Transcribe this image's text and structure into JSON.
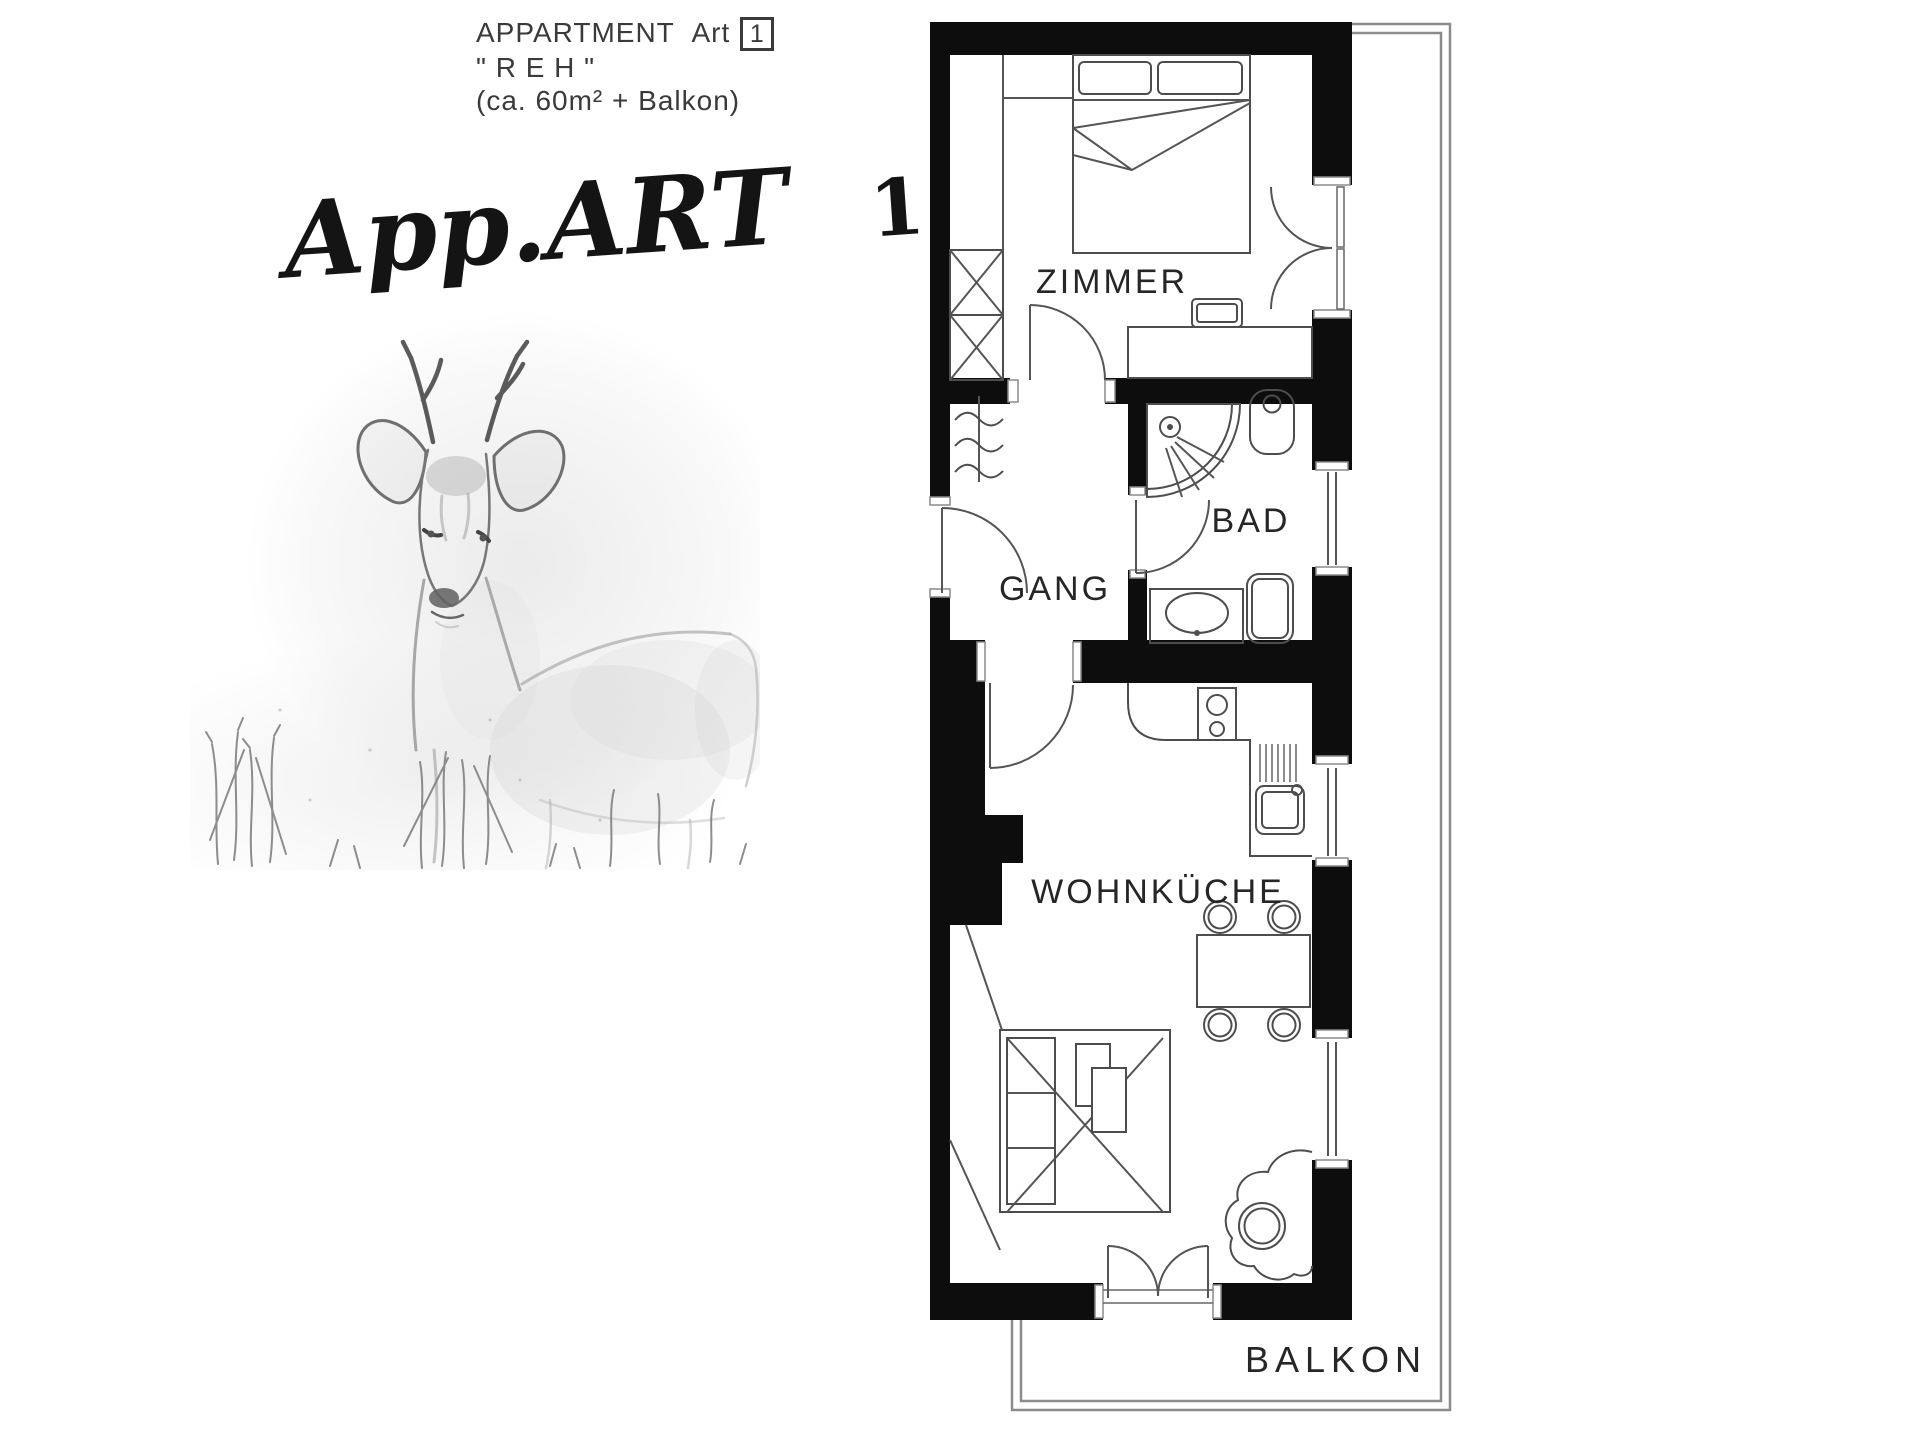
{
  "header": {
    "line1": "APPARTMENT Art",
    "unit": "1",
    "line2": "\" R E H \"",
    "line3": "(ca. 60m² + Balkon)"
  },
  "brand": {
    "script": "App.ART",
    "number": "1"
  },
  "plan": {
    "rooms": {
      "zimmer": "ZIMMER",
      "bad": "BAD",
      "gang": "GANG",
      "wohnkueche": "WOHNKÜCHE",
      "balkon": "BALKON"
    },
    "fixtures": {
      "zimmer": [
        "double-bed",
        "pillows",
        "wardrobe",
        "closet",
        "desk",
        "chair",
        "room-door",
        "balcony-french-door"
      ],
      "bad": [
        "corner-shower",
        "wc",
        "washbasin",
        "bathtub",
        "window",
        "bath-door"
      ],
      "gang": [
        "entrance-door",
        "radiator"
      ],
      "wohnkueche": [
        "kitchen-counter",
        "cooktop",
        "kitchen-sink",
        "dining-table",
        "four-chairs",
        "sofa-bed",
        "plant",
        "balcony-double-door",
        "windows"
      ]
    }
  },
  "colors": {
    "wall": "#0d0d0d",
    "line": "#555555",
    "text": "#2b2b2b",
    "railing": "#8c8c8c",
    "sketch": "#8a8a8a"
  }
}
